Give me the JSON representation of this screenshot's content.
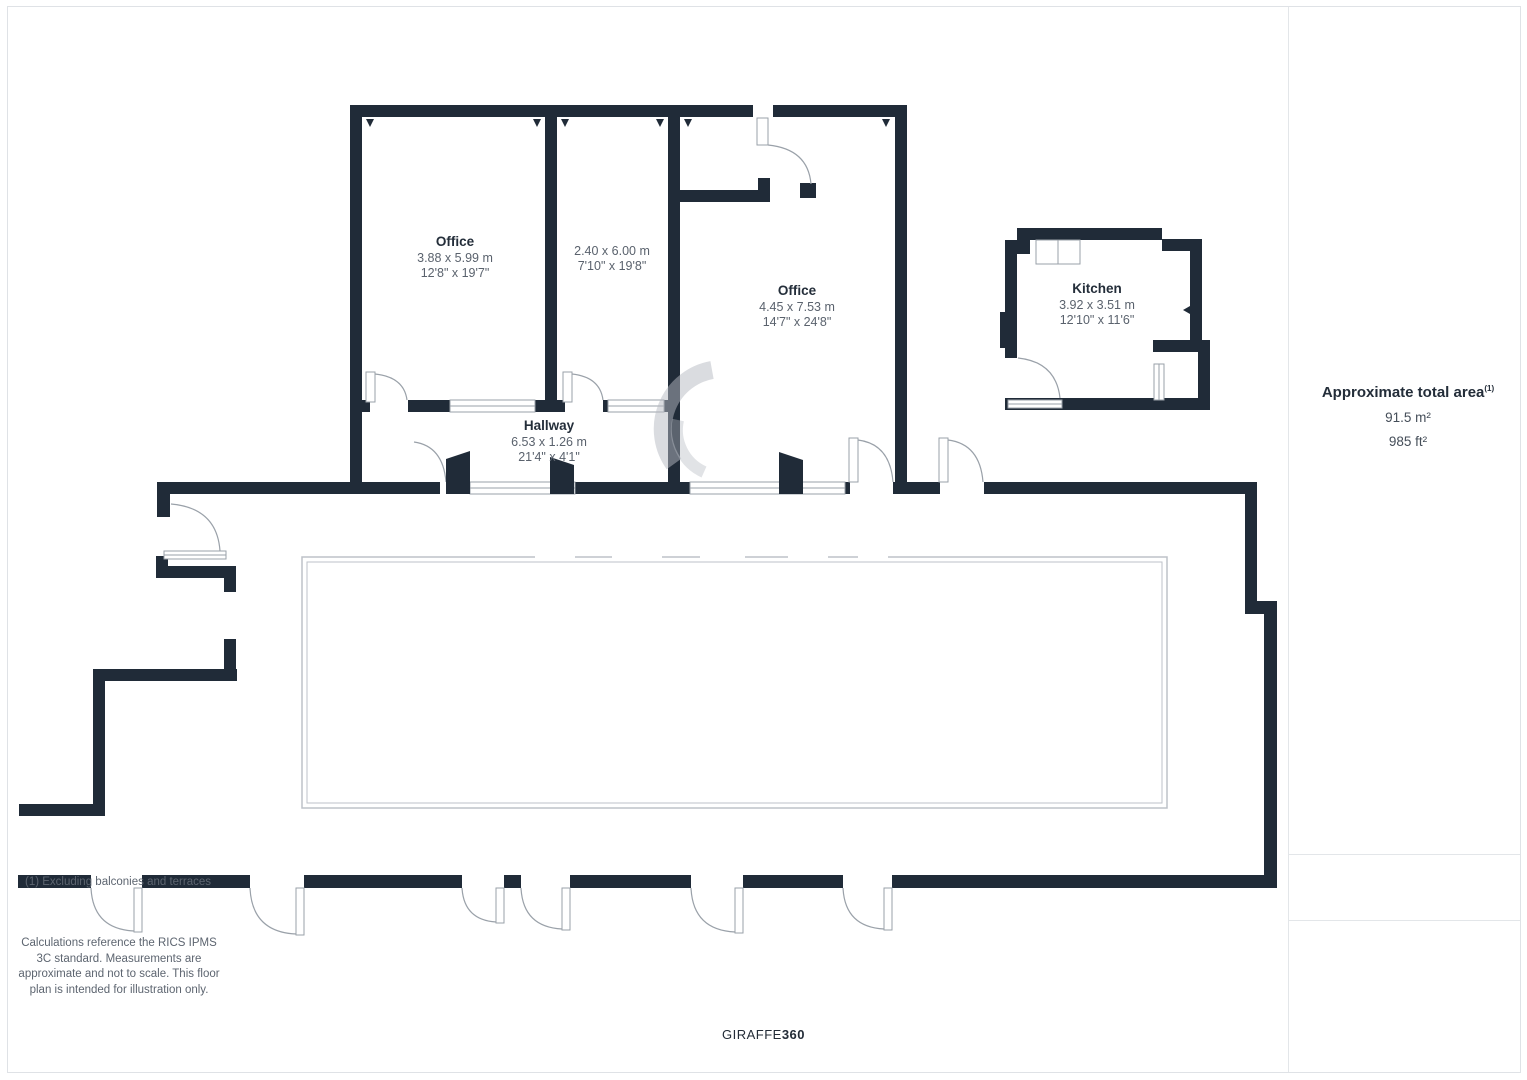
{
  "plan": {
    "rooms": [
      {
        "name": "Office",
        "metric": "3.88 x 5.99 m",
        "imperial": "12'8\" x 19'7\""
      },
      {
        "name": "",
        "metric": "2.40 x 6.00 m",
        "imperial": "7'10\" x 19'8\""
      },
      {
        "name": "Office",
        "metric": "4.45 x 7.53 m",
        "imperial": "14'7\" x 24'8\""
      },
      {
        "name": "Kitchen",
        "metric": "3.92 x 3.51 m",
        "imperial": "12'10\" x 11'6\""
      },
      {
        "name": "Hallway",
        "metric": "6.53 x 1.26 m",
        "imperial": "21'4\" x 4'1\""
      }
    ],
    "colors": {
      "wall": "#202B38",
      "door_line": "#9AA1A9",
      "terrace_line": "#BDC2C8"
    }
  },
  "sidebar": {
    "area_title": "Approximate total area",
    "area_note_ref": "(1)",
    "area_m2": "91.5 m²",
    "area_ft2": "985 ft²",
    "footnote": "(1) Excluding balconies and terraces",
    "disclaimer": "Calculations reference the RICS IPMS 3C standard. Measurements are approximate and not to scale. This floor plan is intended for illustration only.",
    "brand_name": "GIRAFFE",
    "brand_number": "360"
  }
}
